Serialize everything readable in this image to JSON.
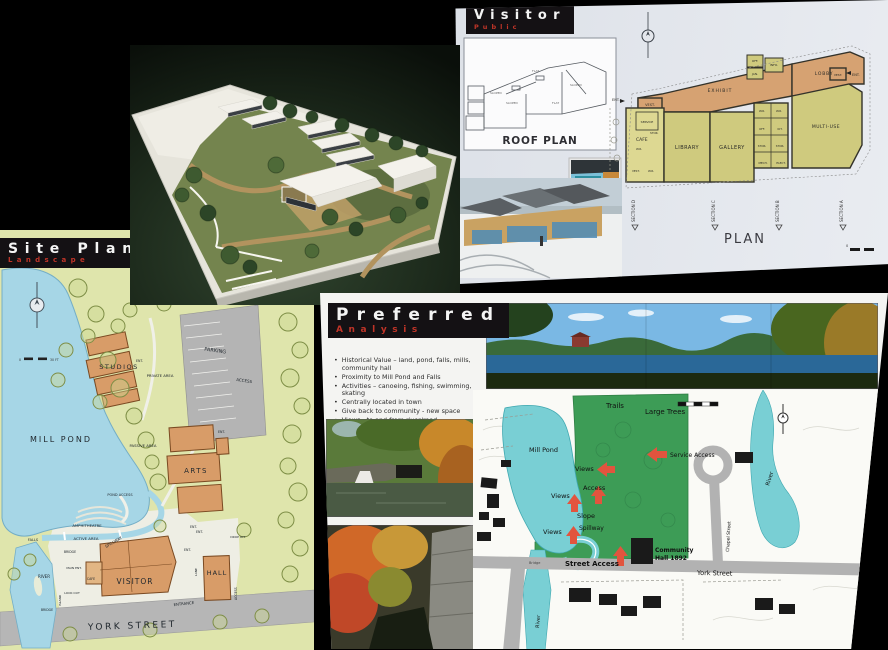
{
  "visitor_board": {
    "title": "Visitor",
    "subtitle": "Public",
    "roof_plan": {
      "caption": "ROOF PLAN",
      "sloped_a": "SLOPED",
      "sloped_b": "SLOPED",
      "sloped_c": "SLOPED",
      "flat_a": "FLAT",
      "flat_b": "FLAT"
    },
    "plan": {
      "caption": "PLAN",
      "scale_zero": "0",
      "rooms": {
        "vest_left": "VEST.",
        "cafe": "CAFE",
        "service": "SERVICE",
        "wr_a": "W.R.",
        "stor_a": "STOR.",
        "vest_cafe": "VEST.",
        "wr_b": "W.R.",
        "exhibit": "EXHIBIT",
        "lobby": "LOBBY",
        "off_a": "OFF.",
        "jan": "JAN.",
        "info": "INFO.",
        "vest_right": "VEST.",
        "ent_right": "ENT.",
        "ent_left": "ENT.",
        "wr_c": "W.R.",
        "wr_d": "W.R.",
        "off_b": "OFF.",
        "kit": "KIT.",
        "stor_b": "STOR.",
        "stor_c": "STOR.",
        "mech": "MECH.",
        "elect": "ELECT.",
        "library": "LIBRARY",
        "gallery": "GALLERY",
        "multi_use": "MULTI-USE"
      },
      "sections": [
        "SECTION D",
        "SECTION C",
        "SECTION B",
        "SECTION A"
      ]
    }
  },
  "siteplan_board": {
    "title": "Site Plan",
    "subtitle": "Landscape",
    "labels": {
      "studios": "STUDIOS",
      "ent_studios": "ENT.",
      "private_area": "PRIVATE AREA",
      "parking": "PARKING",
      "access_parking": "ACCESS",
      "mill_pond": "MILL POND",
      "passive_area": "PASSIVE AREA",
      "arts": "ARTS",
      "ent_arts": "ENT.",
      "ent_arts2": "ENT.",
      "pond_access": "POND ACCESS",
      "amphitheatre": "AMPHITHEATRE",
      "active_area": "ACTIVE AREA",
      "spillway": "SPILLWAY",
      "bridge_upper": "BRIDGE",
      "falls": "FALLS",
      "river": "RIVER",
      "bridge_lower": "BRIDGE",
      "island": "ISLAND",
      "look_out": "LOOK OUT",
      "main_ent": "MAIN ENT.",
      "cafe": "CAFE",
      "visitor": "VISITOR",
      "ent_visitor": "ENT.",
      "entrance": "ENTRANCE",
      "lane": "LANE",
      "hall": "HALL",
      "ent_hall": "ENT.",
      "access_hall": "ACCESS",
      "drop_off": "DROP OFF",
      "york_street": "YORK STREET",
      "scale_zero": "0",
      "scale_len": "30 FT"
    }
  },
  "preferred_board": {
    "title": "Preferred",
    "subtitle": "Analysis",
    "bullets": [
      "Historical Value – land, pond, falls, mills, community hall",
      "Proximity to Mill Pond and Falls",
      "Activities – canoeing, fishing, swimming, skating",
      "Centrally located in town",
      "Give back to community - new space",
      "Views - to and from river/road",
      "Access - car, walk, bike, canoe, trail",
      "Writer's festival – central"
    ],
    "map": {
      "labels": {
        "trails": "Trails",
        "large_trees": "Large Trees",
        "mill_pond": "Mill Pond",
        "views_a": "Views",
        "views_b": "Views",
        "views_c": "Views",
        "access": "Access",
        "service_access": "Service Access",
        "slope": "Slope",
        "spillway": "Spillway",
        "street_access": "Street Access",
        "community_hall_1": "Community",
        "community_hall_2": "Hall 1892",
        "york_street": "York Street",
        "chapel_street": "Chapel Street",
        "river": "River",
        "river_left": "River",
        "bridge": "Bridge"
      }
    }
  }
}
